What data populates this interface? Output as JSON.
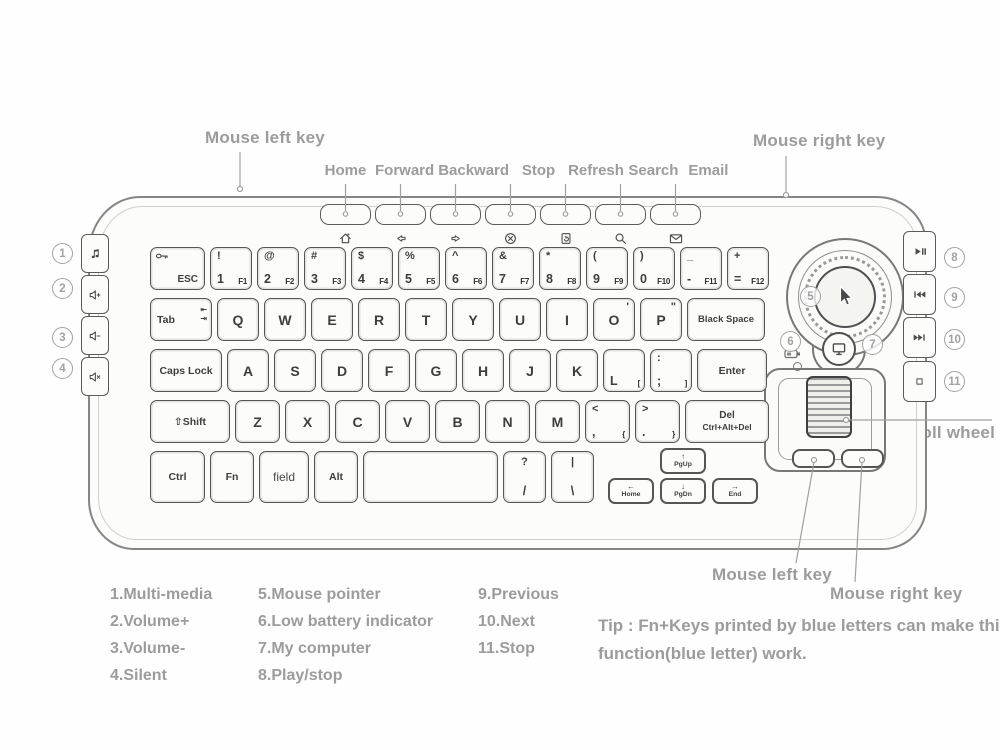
{
  "callouts": {
    "mouse_left_top": "Mouse left key",
    "mouse_right_top": "Mouse right key",
    "scroll_wheel": "Scroll wheel",
    "mouse_left_bottom": "Mouse left key",
    "mouse_right_bottom": "Mouse right key"
  },
  "media_keys": [
    {
      "label": "Home",
      "icon": "home-icon"
    },
    {
      "label": "Forward",
      "icon": "arrow-left-icon"
    },
    {
      "label": "Backward",
      "icon": "arrow-right-icon"
    },
    {
      "label": "Stop",
      "icon": "stop-circle-icon"
    },
    {
      "label": "Refresh",
      "icon": "refresh-page-icon"
    },
    {
      "label": "Search",
      "icon": "search-icon"
    },
    {
      "label": "Email",
      "icon": "email-icon"
    }
  ],
  "side_left_buttons": [
    {
      "num": "1",
      "icon": "music-note-icon"
    },
    {
      "num": "2",
      "icon": "volume-up-icon"
    },
    {
      "num": "3",
      "icon": "volume-down-icon"
    },
    {
      "num": "4",
      "icon": "mute-icon"
    }
  ],
  "side_right_buttons": [
    {
      "num": "8",
      "icon": "play-pause-icon"
    },
    {
      "num": "9",
      "icon": "previous-track-icon"
    },
    {
      "num": "10",
      "icon": "next-track-icon"
    },
    {
      "num": "11",
      "icon": "stop-square-icon"
    }
  ],
  "trackball": {
    "pointer_num": "5",
    "battery_num": "6",
    "computer_num": "7"
  },
  "nav": {
    "home": "Home",
    "pgup": "PgUp",
    "pgdn": "PgDn",
    "end": "End"
  },
  "keyboard": {
    "rows": [
      [
        {
          "main": "ESC",
          "cls": "esc",
          "icon": "key-icon"
        },
        {
          "shift": "!",
          "main": "1",
          "fn": "F1"
        },
        {
          "shift": "@",
          "main": "2",
          "fn": "F2"
        },
        {
          "shift": "#",
          "main": "3",
          "fn": "F3"
        },
        {
          "shift": "$",
          "main": "4",
          "fn": "F4"
        },
        {
          "shift": "%",
          "main": "5",
          "fn": "F5"
        },
        {
          "shift": "^",
          "main": "6",
          "fn": "F6"
        },
        {
          "shift": "&",
          "main": "7",
          "fn": "F7"
        },
        {
          "shift": "*",
          "main": "8",
          "fn": "F8"
        },
        {
          "shift": "(",
          "main": "9",
          "fn": "F9"
        },
        {
          "shift": ")",
          "main": "0",
          "fn": "F10"
        },
        {
          "shift": "_",
          "main": "-",
          "fn": "F11",
          "name": "minus"
        },
        {
          "shift": "+",
          "main": "=",
          "fn": "F12",
          "name": "equals"
        }
      ],
      [
        {
          "main": "Tab",
          "cls": "tab",
          "icon": "tab-arrows-icon"
        },
        {
          "main": "Q"
        },
        {
          "main": "W"
        },
        {
          "main": "E"
        },
        {
          "main": "R"
        },
        {
          "main": "T"
        },
        {
          "main": "Y"
        },
        {
          "main": "U"
        },
        {
          "main": "I"
        },
        {
          "main": "O",
          "tr": "'"
        },
        {
          "main": "P",
          "tr": "\""
        },
        {
          "main": "Black Space",
          "cls": "bspace"
        }
      ],
      [
        {
          "main": "Caps Lock",
          "cls": "caps"
        },
        {
          "main": "A"
        },
        {
          "main": "S"
        },
        {
          "main": "D"
        },
        {
          "main": "F"
        },
        {
          "main": "G"
        },
        {
          "main": "H"
        },
        {
          "main": "J"
        },
        {
          "main": "K"
        },
        {
          "main": "L",
          "fn": "["
        },
        {
          "shift": ":",
          "main": ";",
          "fn": "]",
          "name": "semicolon"
        },
        {
          "main": "Enter",
          "cls": "enter"
        }
      ],
      [
        {
          "main": "⇧Shift",
          "cls": "shiftk",
          "name": "shift"
        },
        {
          "main": "Z"
        },
        {
          "main": "X"
        },
        {
          "main": "C"
        },
        {
          "main": "V"
        },
        {
          "main": "B"
        },
        {
          "main": "N"
        },
        {
          "main": "M"
        },
        {
          "shift": "<",
          "main": ",",
          "fn": "{",
          "name": "comma"
        },
        {
          "shift": ">",
          "main": ".",
          "fn": "}",
          "name": "period"
        },
        {
          "main": "Del",
          "sub": "Ctrl+Alt+Del",
          "cls": "del"
        }
      ],
      [
        {
          "main": "Ctrl",
          "cls": "ctrl"
        },
        {
          "main": "Fn",
          "cls": "fnk",
          "name": "fn"
        },
        {
          "main": "field",
          "cls": "field"
        },
        {
          "main": "Alt",
          "cls": "alt"
        },
        {
          "main": "",
          "cls": "space",
          "name": "space"
        },
        {
          "shift": "?",
          "main": "/",
          "cls": "slash",
          "name": "slash"
        },
        {
          "shift": "|",
          "main": "\\",
          "cls": "bslash",
          "name": "backslash"
        }
      ]
    ]
  },
  "legend": {
    "columns": [
      [
        "1.Multi-media",
        "2.Volume+",
        "3.Volume-",
        "4.Silent"
      ],
      [
        "5.Mouse pointer",
        "6.Low battery indicator",
        "7.My computer",
        "8.Play/stop"
      ],
      [
        "9.Previous",
        "10.Next",
        "11.Stop"
      ]
    ]
  },
  "tip": "Tip : Fn+Keys printed by blue letters can make this function(blue letter) work."
}
